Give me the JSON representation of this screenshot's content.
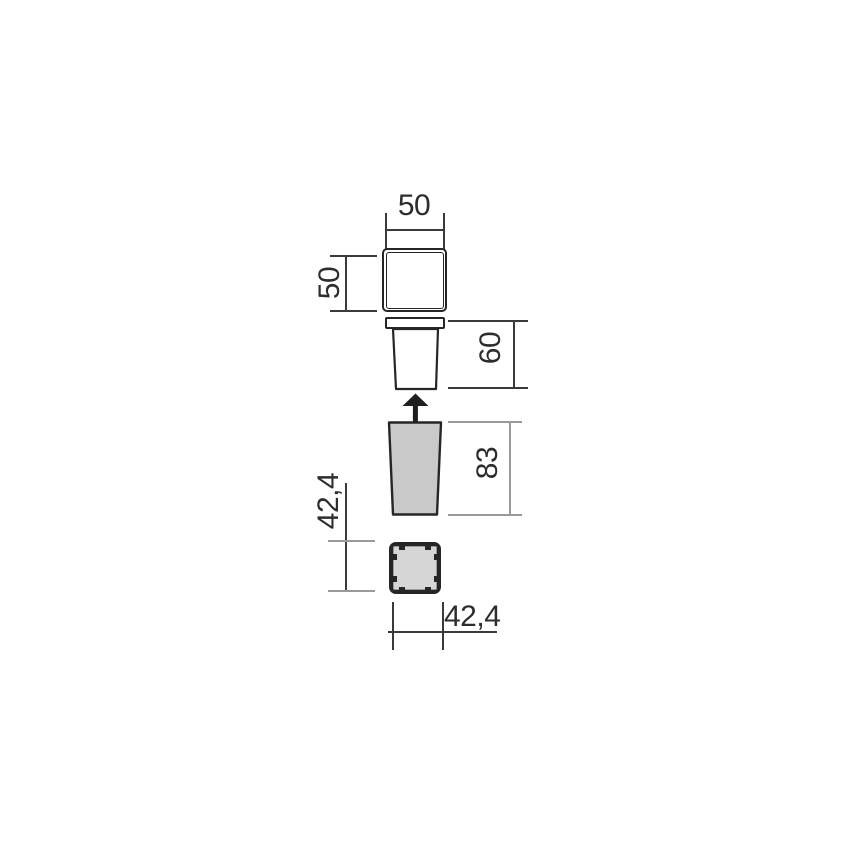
{
  "drawing": {
    "type": "technical-dimension-drawing",
    "dimensions": {
      "cover_width": "50",
      "cover_depth": "50",
      "body_height": "60",
      "sleeve_height": "83",
      "box_depth": "42,4",
      "box_width": "42,4"
    },
    "colors": {
      "line-dark": "#3a3a3a",
      "line-gray": "#9a9a9a",
      "outline": "#262626",
      "fill-sleeve": "#c9c9c9",
      "fill-box": "#d6d6d6",
      "arrow": "#1f1f1f",
      "text": "#2d2d2d"
    }
  }
}
